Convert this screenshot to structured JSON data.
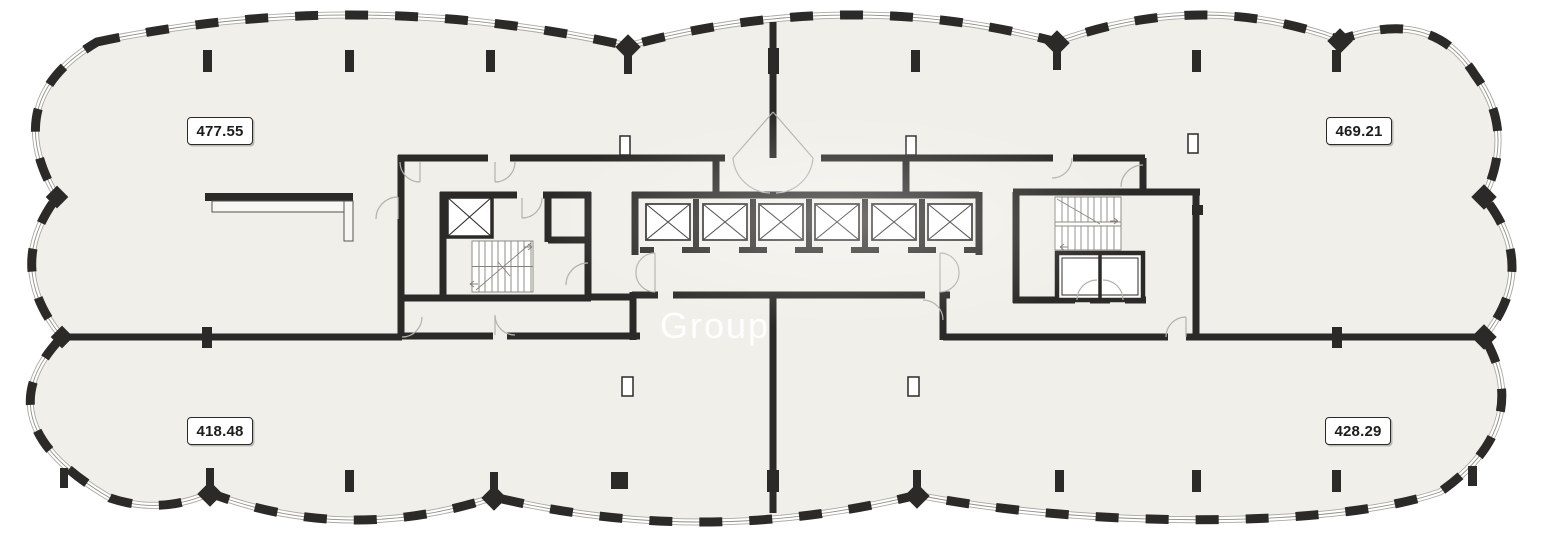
{
  "plan": {
    "title": "floor-plan",
    "area_labels": [
      {
        "id": "top-left",
        "value": "477.55"
      },
      {
        "id": "top-right",
        "value": "469.21"
      },
      {
        "id": "bottom-left",
        "value": "418.48"
      },
      {
        "id": "bottom-right",
        "value": "428.29"
      }
    ],
    "watermark": "Group",
    "colors": {
      "floor": "#f1efe9",
      "wall": "#2b2a28",
      "glazing_line": "#8f8e88",
      "background": "#ffffff"
    }
  }
}
